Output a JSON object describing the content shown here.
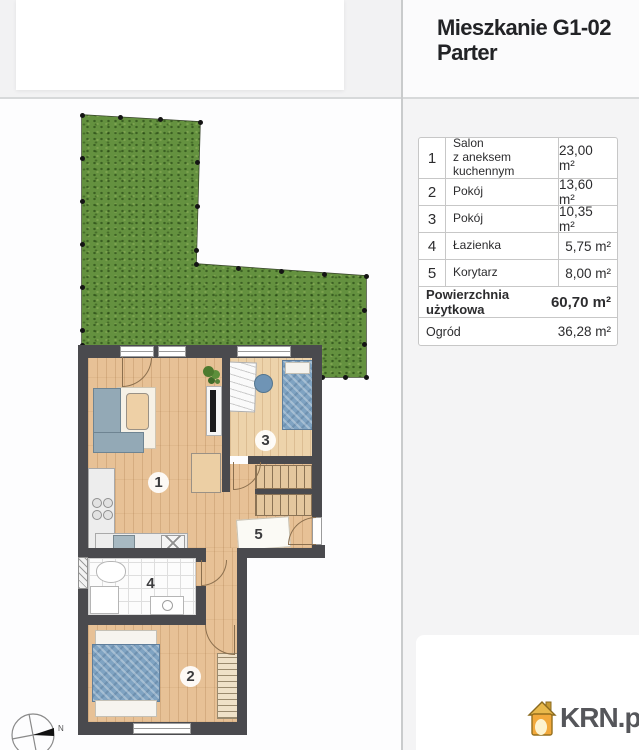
{
  "header": {
    "title_line1": "Mieszkanie G1-02",
    "title_line2": "Parter"
  },
  "rooms_table": {
    "rows": [
      {
        "num": "1",
        "name": "Salon\nz aneksem kuchennym",
        "area": "23,00 m²"
      },
      {
        "num": "2",
        "name": "Pokój",
        "area": "13,60 m²"
      },
      {
        "num": "3",
        "name": "Pokój",
        "area": "10,35 m²"
      },
      {
        "num": "4",
        "name": "Łazienka",
        "area": "5,75 m²"
      },
      {
        "num": "5",
        "name": "Korytarz",
        "area": "8,00 m²"
      }
    ],
    "total_label": "Powierzchnia użytkowa",
    "total_area": "60,70 m²",
    "garden_label": "Ogród",
    "garden_area": "36,28 m²"
  },
  "plan": {
    "room_labels": {
      "r1": "1",
      "r2": "2",
      "r3": "3",
      "r4": "4",
      "r5": "5"
    },
    "compass_north": "N"
  },
  "footer": {
    "brand": "KRN.pl"
  },
  "colors": {
    "wall": "#4a4a4e",
    "grass": "#64913f",
    "accent_orange": "#f0a432",
    "panel_gray": "#f4f4f5"
  }
}
